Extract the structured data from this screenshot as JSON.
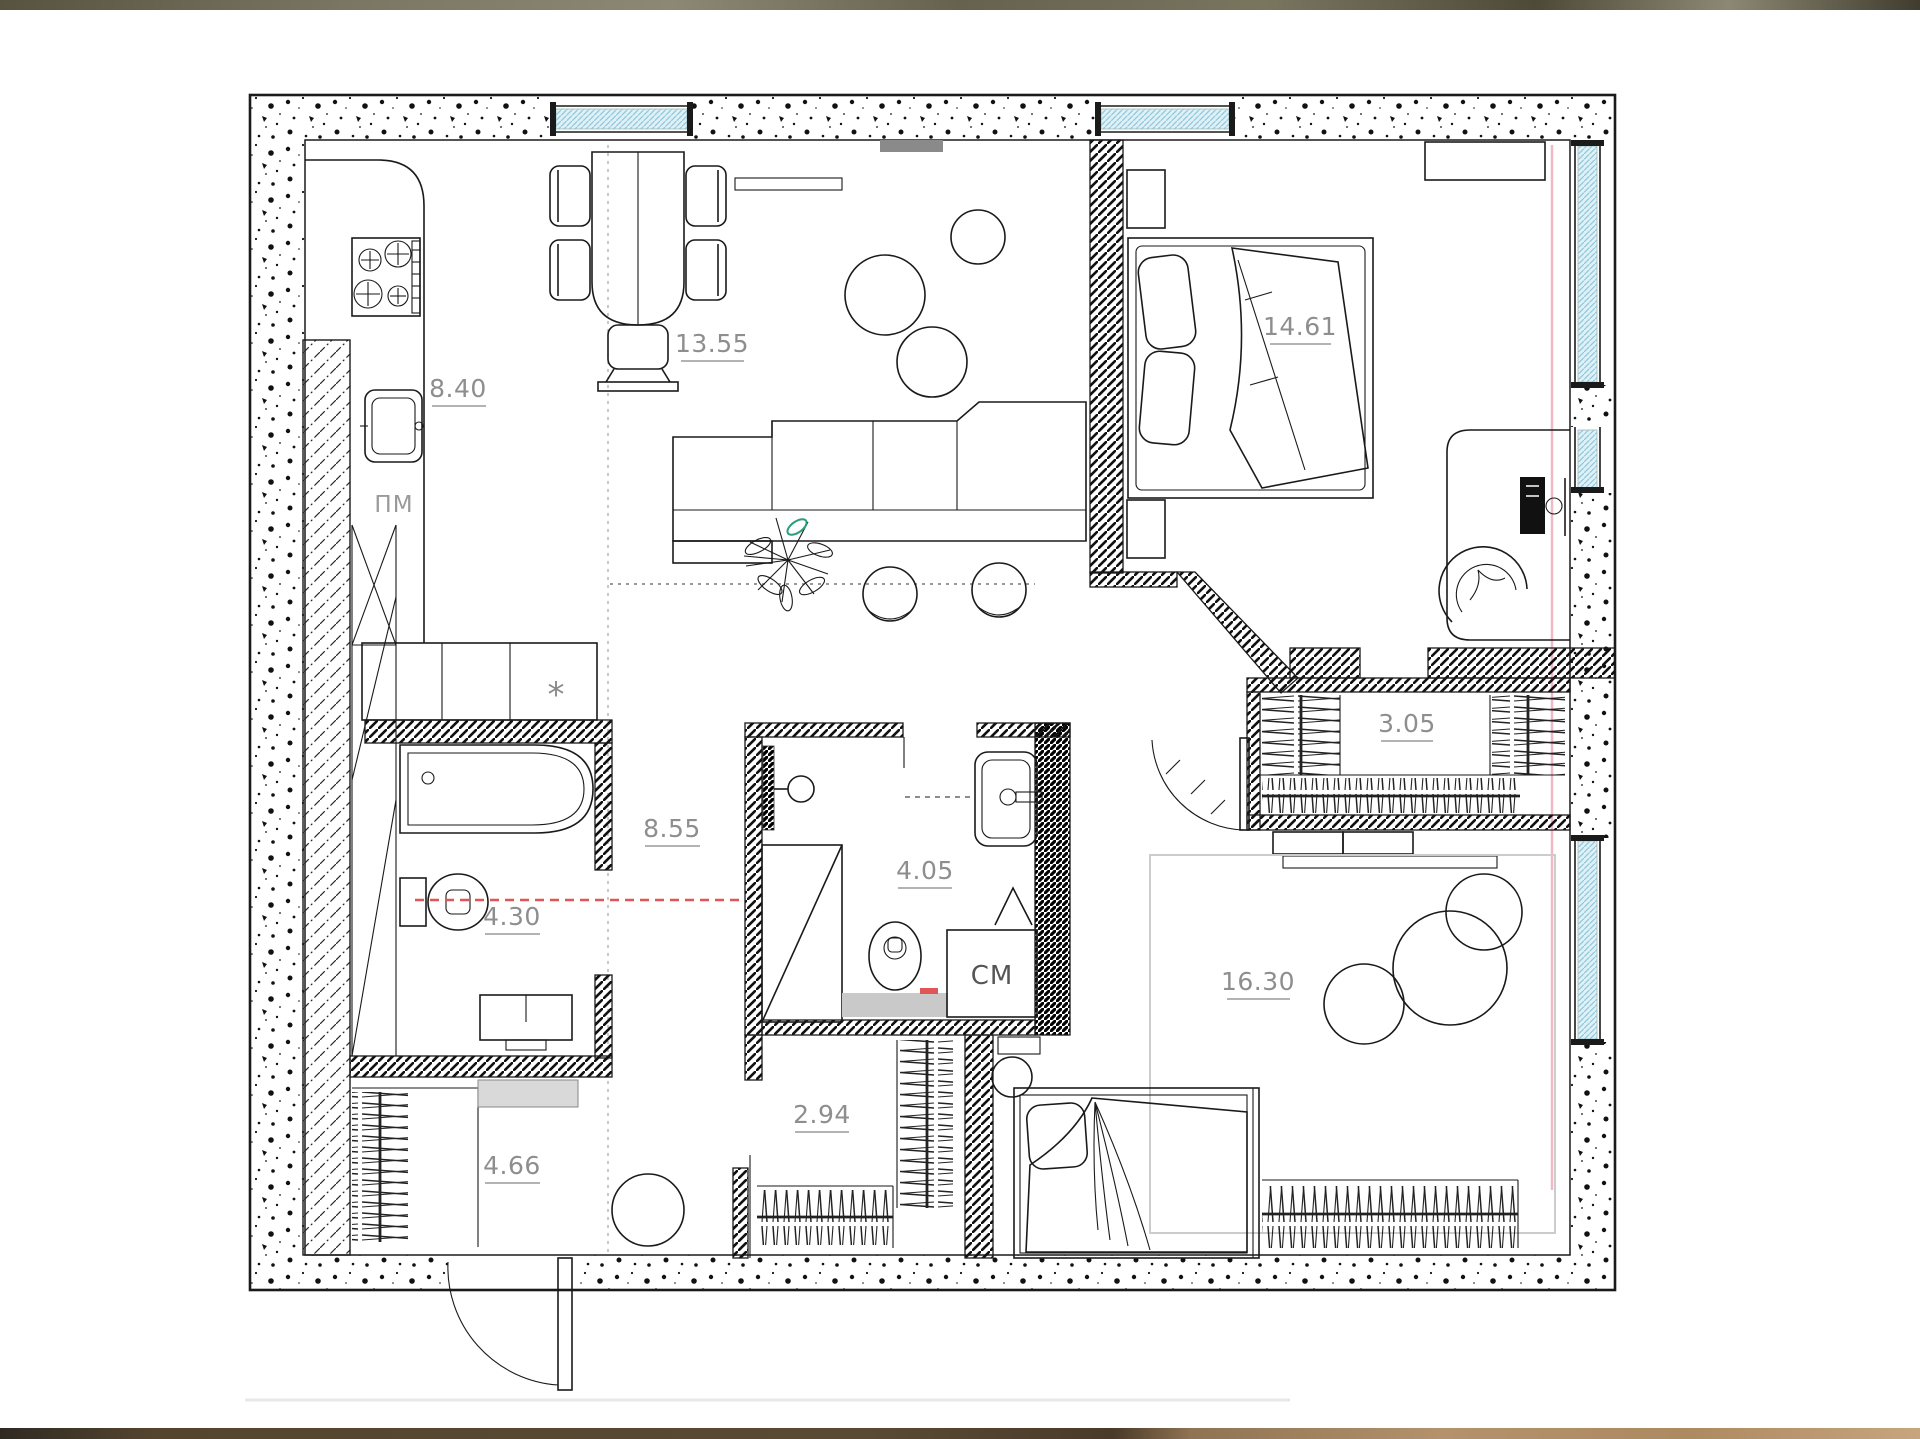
{
  "plan": {
    "labels": {
      "kitchen": "8.40",
      "dining_living": "13.55",
      "bedroom": "14.61",
      "bedroom_closet": "3.05",
      "hallway": "8.55",
      "bathroom": "4.30",
      "shower_room": "4.05",
      "hall_closet": "2.94",
      "entry": "4.66",
      "kids_room": "16.30"
    },
    "annotations": {
      "dishwasher": "ПМ",
      "washing_machine": "СМ",
      "cabinet_mark": "*"
    },
    "colors": {
      "wall_ink": "#1a1a1a",
      "label_gray": "#8e8e8e",
      "window_blue": "#dff0f7",
      "window_hatch_blue": "#8fc8da",
      "accent_red": "#e05555",
      "accent_pink": "#f2b8c6",
      "plant_green": "#2a9d7c",
      "rug_gray": "#d9d9d9",
      "mat_gray": "#c9c9c9",
      "radiator_gray": "#8a8a8a",
      "top_strip_olive": "#6e6a55",
      "bottom_strip_brown": "#5a4a33",
      "bottom_strip_wood": "#b3926c"
    }
  }
}
